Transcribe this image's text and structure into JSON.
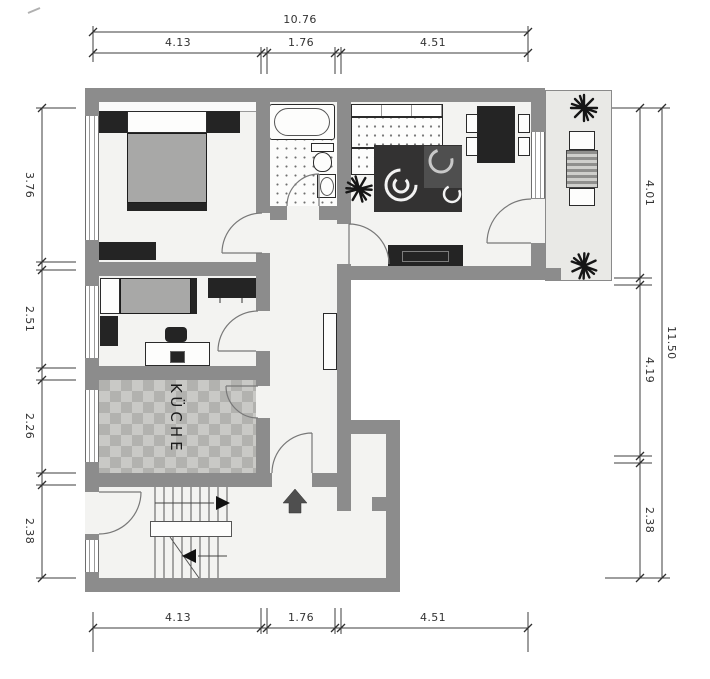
{
  "rooms": {
    "kitchen_label": "KÜCHE"
  },
  "dimensions": {
    "top": {
      "total": "10.76",
      "segments": [
        "4.13",
        "1.76",
        "4.51"
      ]
    },
    "bottom": {
      "segments": [
        "4.13",
        "1.76",
        "4.51"
      ]
    },
    "left": {
      "segments": [
        "3.76",
        "2.51",
        "2.26",
        "2.38"
      ]
    },
    "right": {
      "total": "11.50",
      "segments": [
        "4.01",
        "4.19",
        "2.38"
      ]
    }
  },
  "colors": {
    "wall": "#8c8c8c",
    "floor": "#f3f3f1",
    "balcony_floor": "#e9e9e6",
    "dark": "#242424",
    "bed": "#a8a8a7",
    "rug": "#333232",
    "checker_a": "#c9c9c6",
    "checker_b": "#b2b2af",
    "dim": "#333333"
  }
}
